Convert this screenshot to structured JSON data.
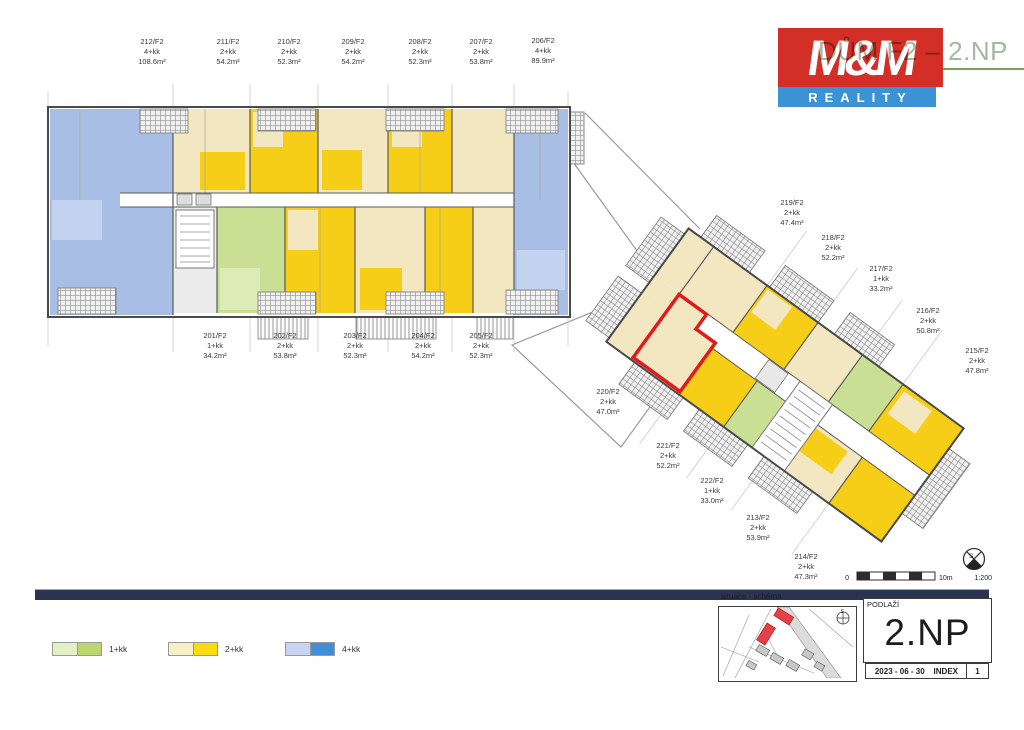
{
  "header": {
    "title": "DŮM F2 – 2.NP",
    "logo_text": "M&M",
    "logo_subtext": "REALITY",
    "brand_red": "#d32f27",
    "brand_blue": "#3b93d6",
    "title_color": "#a3b89f"
  },
  "units": [
    {
      "id": "212/F2",
      "type": "4+kk",
      "area": "108.6m²"
    },
    {
      "id": "211/F2",
      "type": "2+kk",
      "area": "54.2m²"
    },
    {
      "id": "210/F2",
      "type": "2+kk",
      "area": "52.3m²"
    },
    {
      "id": "209/F2",
      "type": "2+kk",
      "area": "54.2m²"
    },
    {
      "id": "208/F2",
      "type": "2+kk",
      "area": "52.3m²"
    },
    {
      "id": "207/F2",
      "type": "2+kk",
      "area": "53.8m²"
    },
    {
      "id": "206/F2",
      "type": "4+kk",
      "area": "89.9m²"
    },
    {
      "id": "201/F2",
      "type": "1+kk",
      "area": "34.2m²"
    },
    {
      "id": "202/F2",
      "type": "2+kk",
      "area": "53.8m²"
    },
    {
      "id": "203/F2",
      "type": "2+kk",
      "area": "52.3m²"
    },
    {
      "id": "204/F2",
      "type": "2+kk",
      "area": "54.2m²"
    },
    {
      "id": "205/F2",
      "type": "2+kk",
      "area": "52.3m²"
    },
    {
      "id": "219/F2",
      "type": "2+kk",
      "area": "47.4m²"
    },
    {
      "id": "218/F2",
      "type": "2+kk",
      "area": "52.2m²"
    },
    {
      "id": "217/F2",
      "type": "1+kk",
      "area": "33.2m²"
    },
    {
      "id": "216/F2",
      "type": "2+kk",
      "area": "50.8m²"
    },
    {
      "id": "215/F2",
      "type": "2+kk",
      "area": "47.8m²"
    },
    {
      "id": "220/F2",
      "type": "2+kk",
      "area": "47.0m²"
    },
    {
      "id": "221/F2",
      "type": "2+kk",
      "area": "52.2m²"
    },
    {
      "id": "222/F2",
      "type": "1+kk",
      "area": "33.0m²"
    },
    {
      "id": "213/F2",
      "type": "2+kk",
      "area": "53.9m²"
    },
    {
      "id": "214/F2",
      "type": "2+kk",
      "area": "47.3m²"
    }
  ],
  "highlighted_unit": "220/F2",
  "legend": {
    "items": [
      {
        "label": "1+kk",
        "light": "#e4efc6",
        "dark": "#bcd56e"
      },
      {
        "label": "2+kk",
        "light": "#f6f0c8",
        "dark": "#f9dc0f"
      },
      {
        "label": "4+kk",
        "light": "#c9d4f0",
        "dark": "#3f8fd8"
      }
    ]
  },
  "scale_bar": {
    "zero": "0",
    "max": "10m",
    "ratio": "1:200"
  },
  "compass": {
    "label": "S"
  },
  "title_block": {
    "map_label": "situace - schéma",
    "floor_label": "PODLAŽÍ",
    "floor": "2.NP",
    "date": "2023 - 06 - 30",
    "index_label": "INDEX",
    "index_value": "1"
  },
  "plan_colors": {
    "yellow": "#f6ce18",
    "cream": "#f3e7c2",
    "green": "#c9df93",
    "blue": "#a9bee5",
    "highlight": "#e01b1b",
    "footer_bar": "#2a3350"
  }
}
